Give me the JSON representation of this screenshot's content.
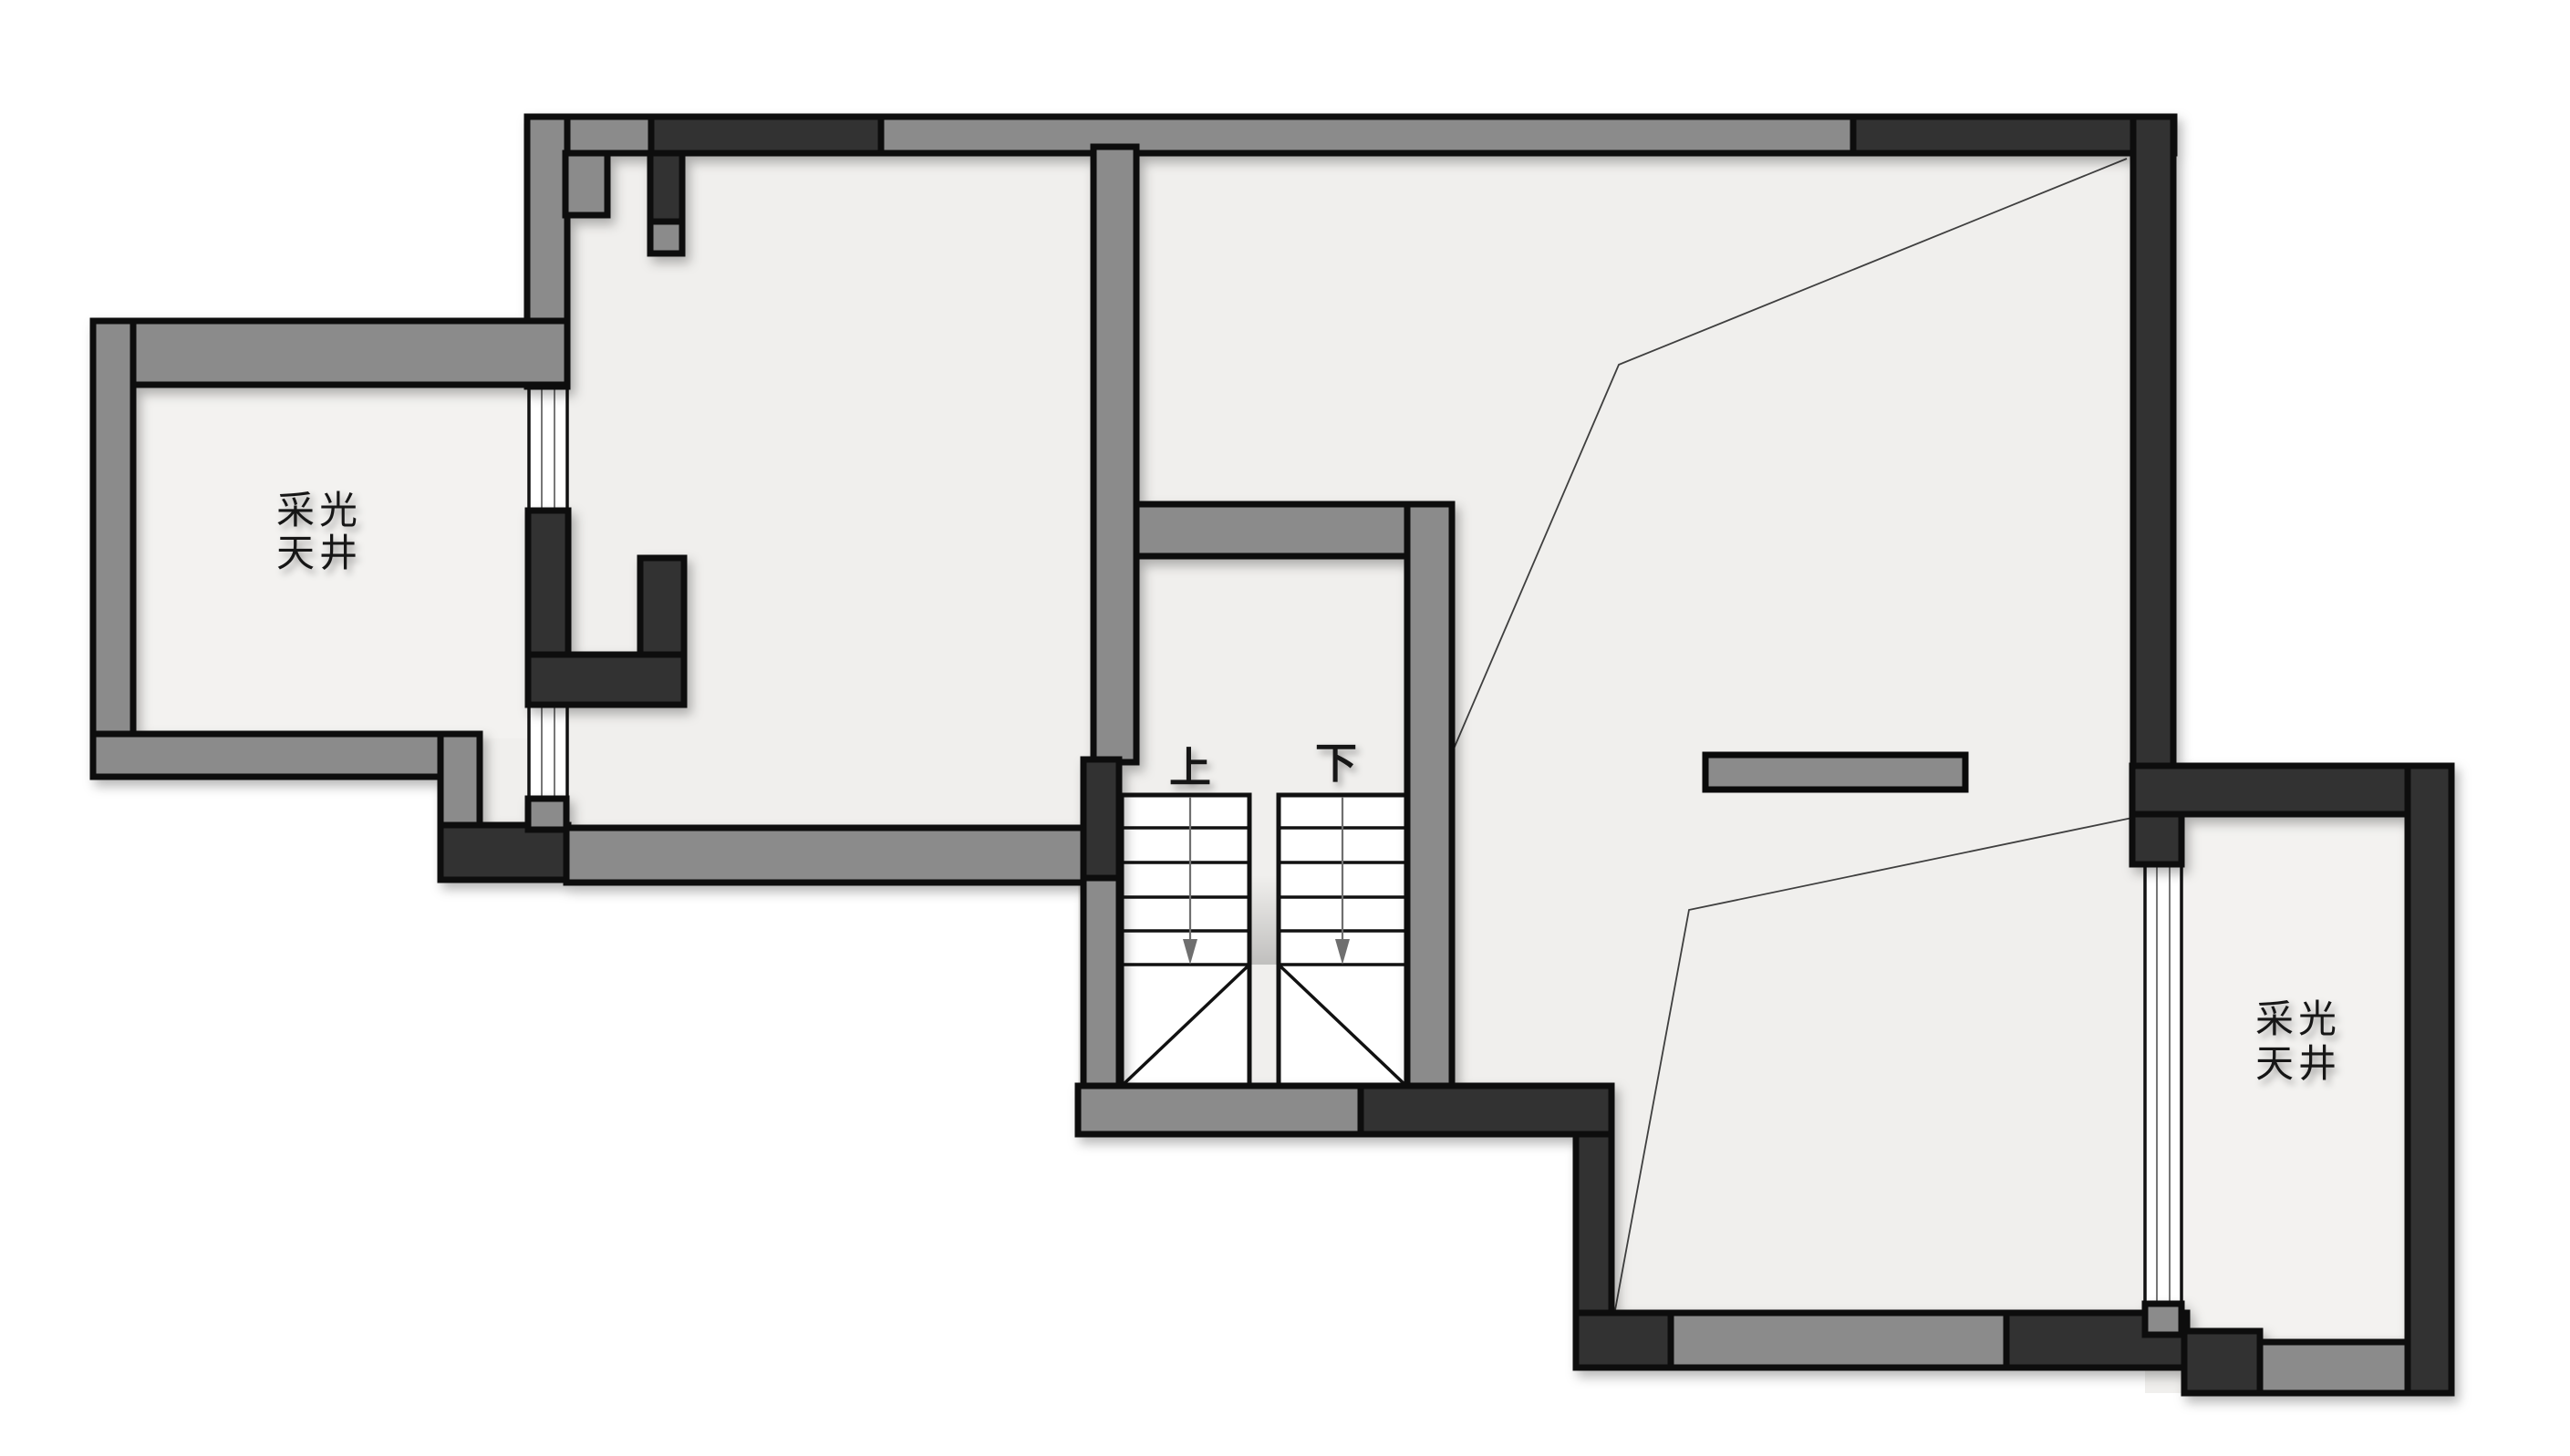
{
  "plan": {
    "type": "architectural-floor-plan",
    "colors": {
      "canvas": "#ffffff",
      "floor": "#f0efed",
      "lightwell_floor": "#f3f2f0",
      "wall_gray": "#8b8b8b",
      "wall_dark": "#333333",
      "edge": "#0a0a0a",
      "thin_line": "#3f3f3f",
      "window_line": "#555555",
      "arrow": "#6f6f6f",
      "text": "#161616"
    },
    "rooms": {
      "left_lightwell": {
        "label_line1": "采光",
        "label_line2": "天井"
      },
      "right_lightwell": {
        "label_line1": "采光",
        "label_line2": "天井"
      }
    },
    "stairs": {
      "up_label": "上",
      "down_label": "下"
    }
  }
}
